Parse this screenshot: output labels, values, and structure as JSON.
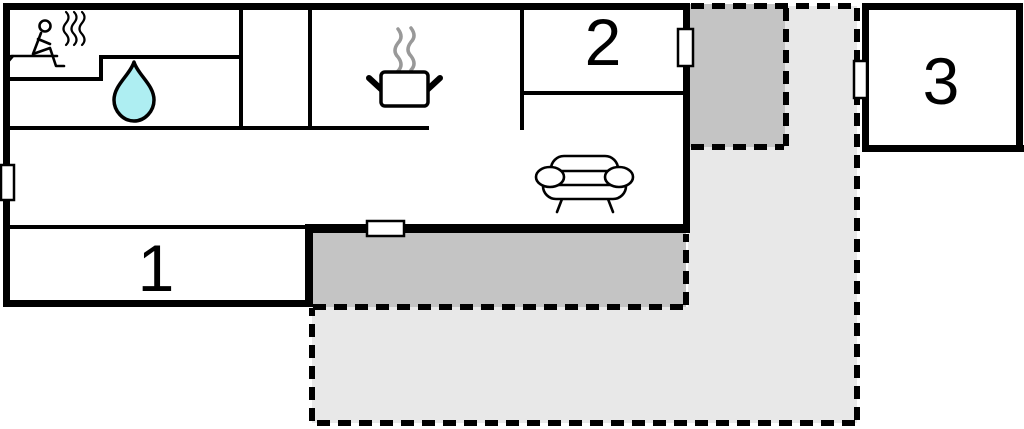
{
  "plan": {
    "rooms": [
      {
        "label": "1"
      },
      {
        "label": "2"
      },
      {
        "label": "3"
      }
    ],
    "icons": {
      "sauna": "sauna-person-icon",
      "bathroom": "water-drop-icon",
      "kitchen": "cooking-pot-icon",
      "living_room": "sofa-icon"
    },
    "colors": {
      "wall": "#000000",
      "terrace_dark": "#c4c4c4",
      "terrace_light": "#e8e8e8",
      "water_drop": "#aeeef2",
      "steam_gray": "#999999",
      "door_fill": "#ffffff"
    }
  }
}
